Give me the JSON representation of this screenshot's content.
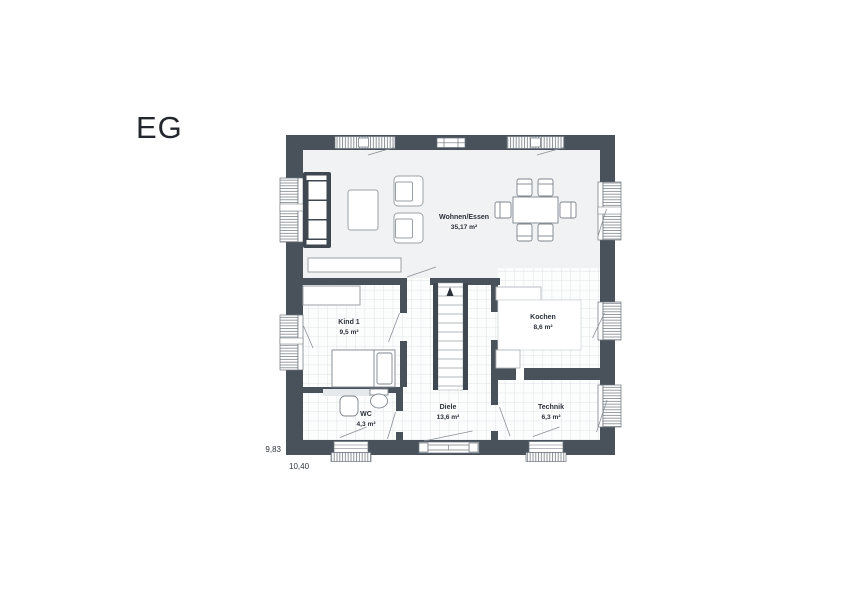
{
  "title": "EG",
  "rooms": [
    {
      "name": "Wohnen/Essen",
      "area": "35,17 m²"
    },
    {
      "name": "Kind 1",
      "area": "9,5 m²"
    },
    {
      "name": "Kochen",
      "area": "8,6 m²"
    },
    {
      "name": "Diele",
      "area": "13,6 m²"
    },
    {
      "name": "WC",
      "area": "4,3 m²"
    },
    {
      "name": "Technik",
      "area": "6,3 m²"
    }
  ],
  "dimensions": {
    "height": "9,83",
    "width": "10,40"
  },
  "icons": {
    "stairs_direction": "up-arrow"
  },
  "colors": {
    "wall": "#49515a",
    "living_floor": "#f1f2f3",
    "tile_line": "#e1e5e7",
    "furniture_outline": "#9aa1a7",
    "label_text": "#2b313a"
  }
}
